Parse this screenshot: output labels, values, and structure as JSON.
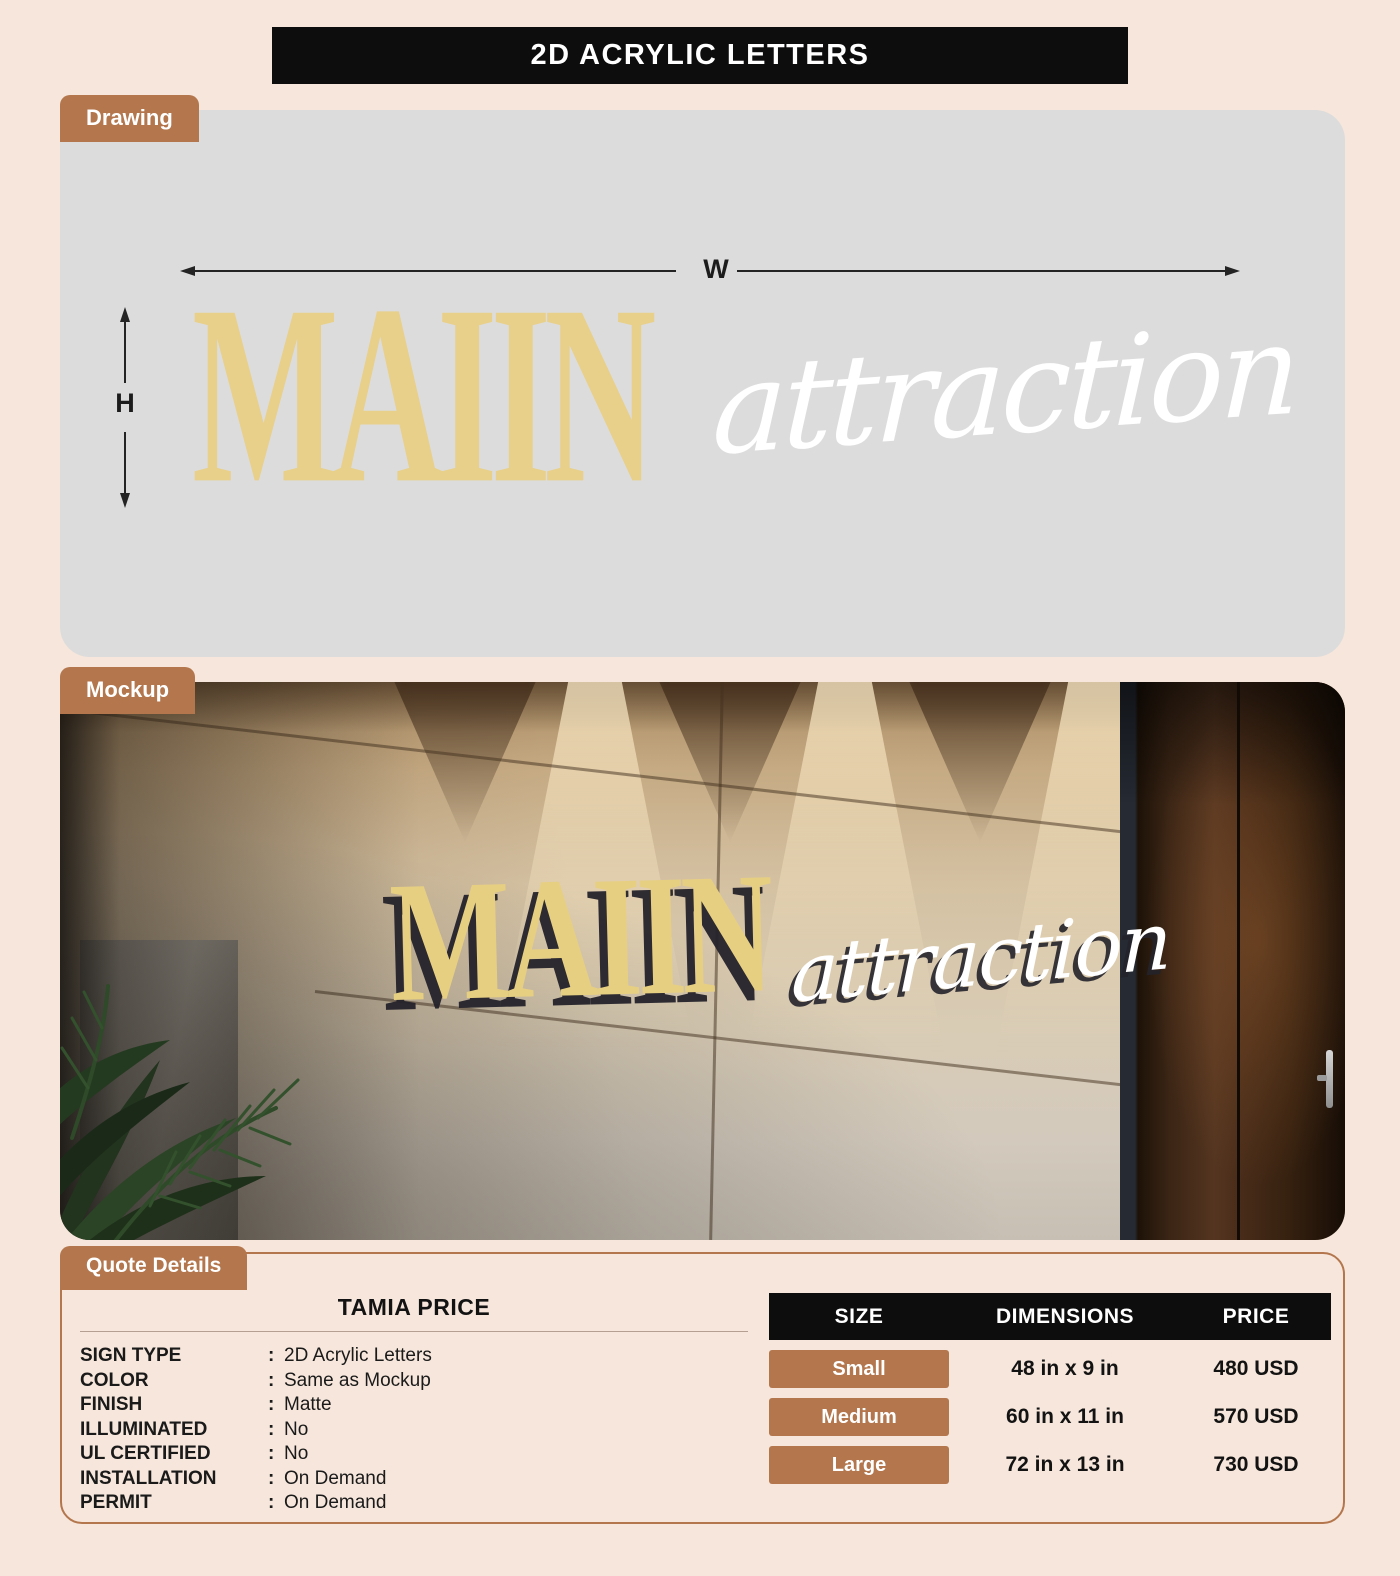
{
  "page": {
    "title": "2D ACRYLIC LETTERS",
    "background_color": "#f7e6db",
    "accent_color": "#b3764d",
    "banner_color": "#0e0d0d"
  },
  "drawing": {
    "tab_label": "Drawing",
    "panel_color": "#dcdcdc",
    "width_label": "W",
    "height_label": "H",
    "sign_line1": "MAIIN",
    "sign_line2": "attraction",
    "sign_line1_color": "#e8d08a",
    "sign_line2_color": "#ffffff"
  },
  "mockup": {
    "tab_label": "Mockup",
    "sign_line1": "MAIIN",
    "sign_line2": "attraction"
  },
  "quote": {
    "tab_label": "Quote Details",
    "customer_name": "TAMIA PRICE",
    "colon": ":",
    "fields": [
      {
        "label": "SIGN TYPE",
        "value": "2D Acrylic Letters"
      },
      {
        "label": "COLOR",
        "value": "Same as Mockup"
      },
      {
        "label": "FINISH",
        "value": "Matte"
      },
      {
        "label": "ILLUMINATED",
        "value": "No"
      },
      {
        "label": "UL CERTIFIED",
        "value": "No"
      },
      {
        "label": "INSTALLATION",
        "value": "On Demand"
      },
      {
        "label": "PERMIT",
        "value": "On Demand"
      }
    ],
    "table": {
      "headers": [
        "SIZE",
        "DIMENSIONS",
        "PRICE"
      ],
      "rows": [
        {
          "size": "Small",
          "dimensions": "48 in x 9 in",
          "price": "480 USD"
        },
        {
          "size": "Medium",
          "dimensions": "60 in x 11 in",
          "price": "570 USD"
        },
        {
          "size": "Large",
          "dimensions": "72 in x 13 in",
          "price": "730 USD"
        }
      ]
    }
  }
}
